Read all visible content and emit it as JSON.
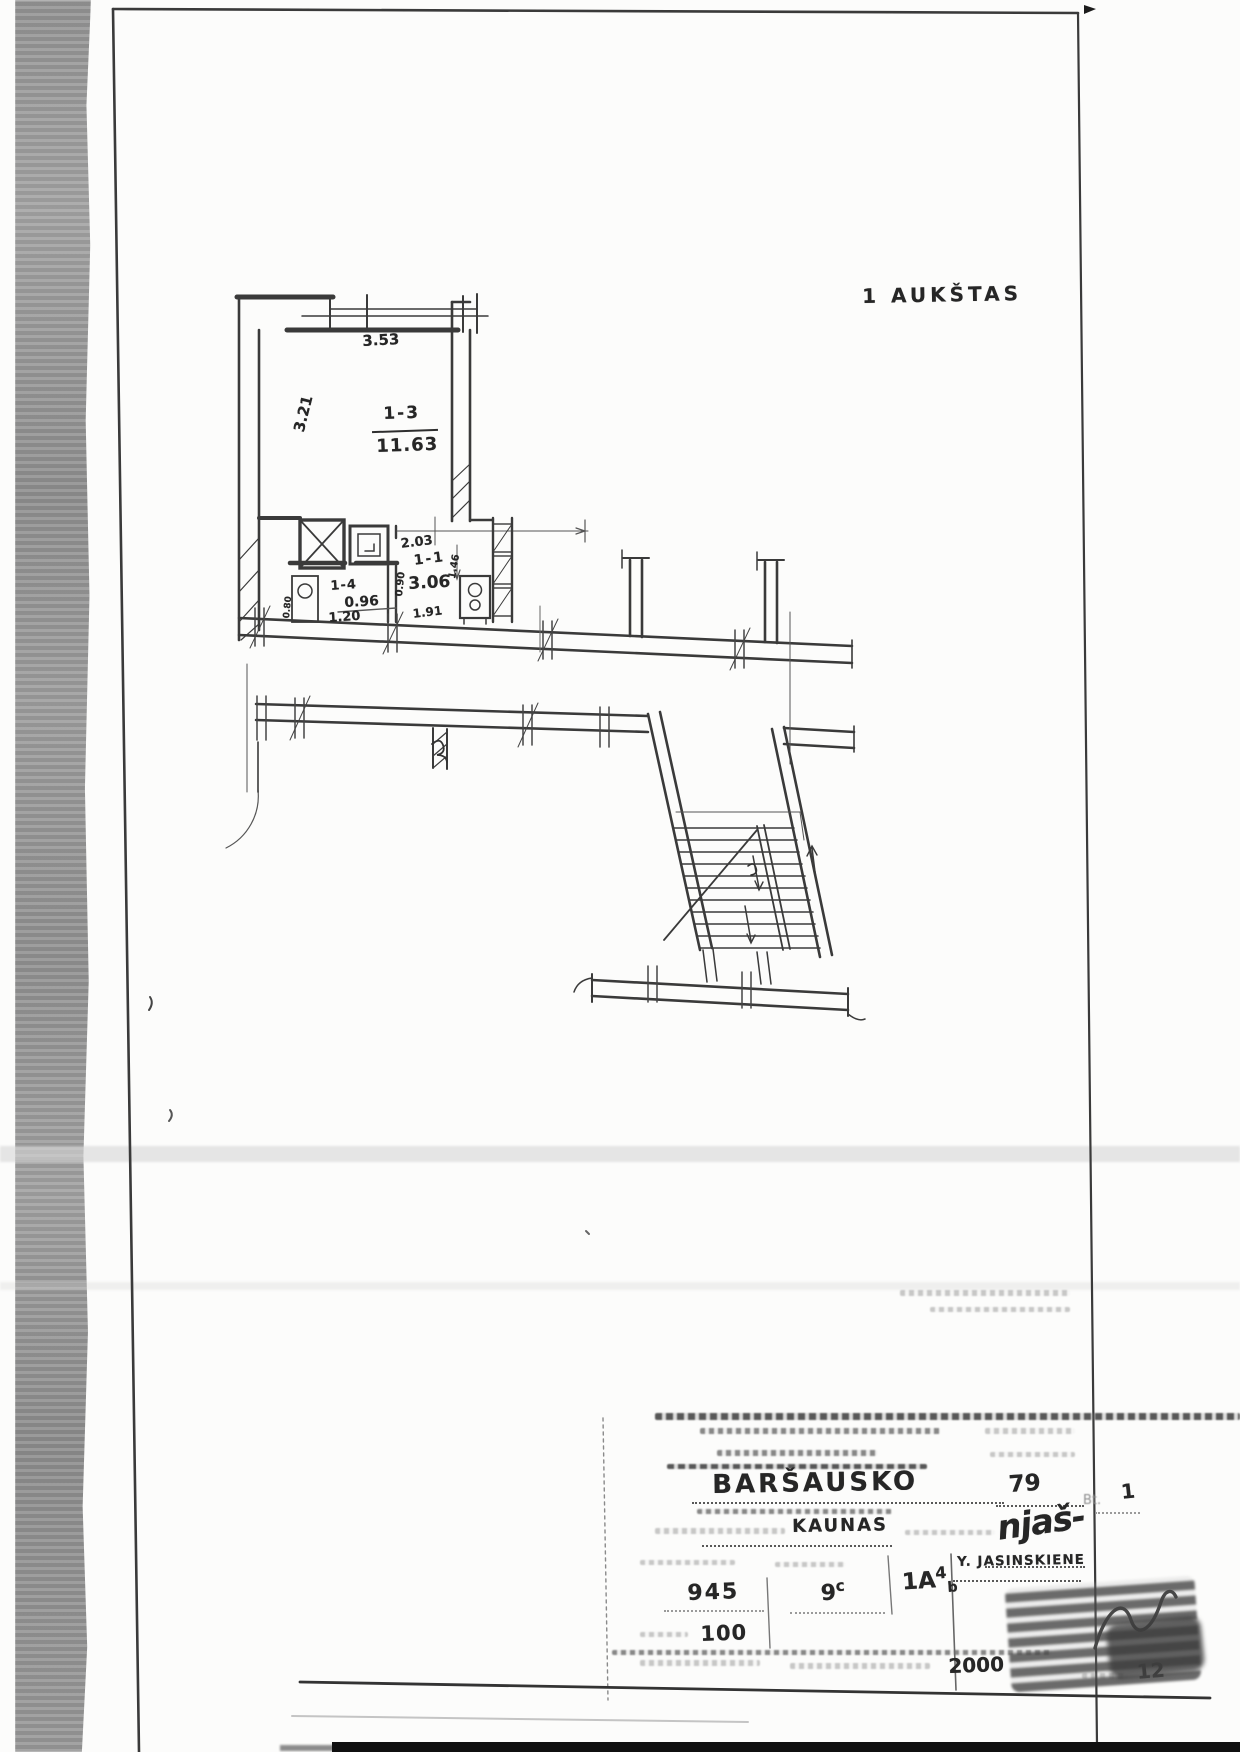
{
  "page": {
    "floor_label": "1 AUKŠTAS"
  },
  "plan": {
    "rooms": [
      {
        "number": "1-3",
        "area": "11.63"
      },
      {
        "number": "1-1",
        "area": "3.06"
      },
      {
        "number": "1-4",
        "area": "0.96"
      }
    ],
    "dims": {
      "w353": "3.53",
      "h321": "3.21",
      "d203": "2.03",
      "d090": "0.90",
      "d191": "1.91",
      "d120": "1.20",
      "d146": "1.46",
      "d080": "0.80"
    }
  },
  "title_block": {
    "street": "BARŠAUSKO",
    "house_no": "79",
    "apt_label": "Bt.",
    "apt_no": "1",
    "city": "KAUNAS",
    "signature": "njaš-",
    "surveyor": "Y. JASINSKIENE",
    "inventory_no": "945",
    "sheet_main": "9",
    "sheet_sup": "c",
    "format_main": "1A",
    "format_sup": "4",
    "format_sub": "b",
    "scale": "100",
    "year": "2000",
    "page_no": "12"
  }
}
